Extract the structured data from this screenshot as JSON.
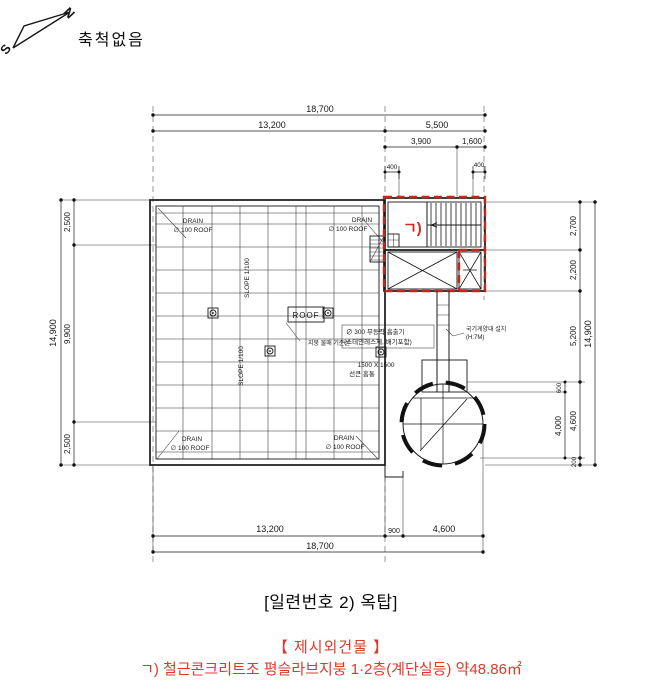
{
  "compass": {
    "north": "N",
    "south": "S",
    "note": "축척없음"
  },
  "dims": {
    "top_overall": "18,700",
    "top_l": "13,200",
    "top_r": "5,500",
    "top_s1": "3,900",
    "top_s2": "1,600",
    "top_400l": "400",
    "top_400r": "400",
    "left_overall": "14,900",
    "left_a": "2,500",
    "left_b": "9,900",
    "left_c": "2,500",
    "right_overall": "14,900",
    "right_a": "2,700",
    "right_b": "2,200",
    "right_c": "5,200",
    "right_d": "4,600",
    "right_600": "600",
    "right_4000": "4,000",
    "right_200": "200",
    "bot_l": "13,200",
    "bot_900": "900",
    "bot_r": "4,600",
    "bot_overall": "18,700"
  },
  "labels": {
    "drain1": "DRAIN",
    "drain2": "∅ 100 ROOF",
    "slope": "SLOPE 1/100",
    "roof": "ROOF",
    "vent1": "∅ 300 무동력 흡출기",
    "vent2": "(스테인레스제, 배기포함)",
    "slope_ref": "지붕 물매 기준선",
    "sunken1": "1500 X 1500",
    "sunken2": "선큰 홈통",
    "flag1": "국기게양대 설치",
    "flag2": "(H:7M)",
    "mark": "ㄱ)"
  },
  "caption": "[일련번호 2) 옥탑]",
  "annotation": {
    "title": "【 제시외건물 】",
    "line1": "ㄱ) 철근콘크리트조 평슬라브지붕 1·2층(계단실등) 약48.86㎡"
  },
  "colors": {
    "ink": "#181818",
    "red_outline": "#c4261a",
    "red_text": "#df382b"
  }
}
